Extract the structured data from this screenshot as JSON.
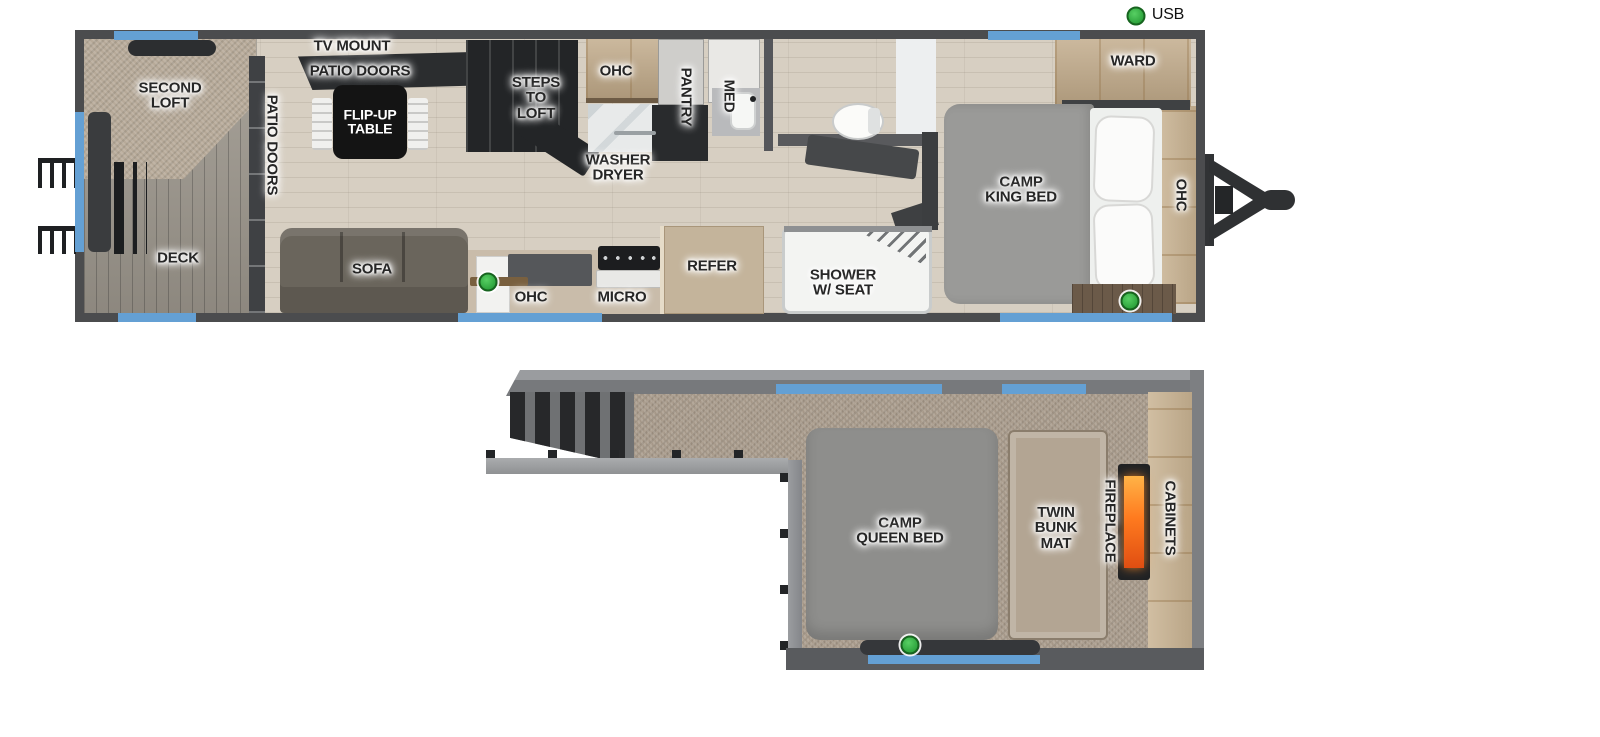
{
  "legend": {
    "usb": "USB",
    "usb_color": "#3db54a"
  },
  "colors": {
    "wall_dark": "#4b4c4e",
    "wall_light": "#85878a",
    "window_blue": "#64a0d4",
    "usb_green": "#3db54a",
    "fire_orange": "#ff7b1f",
    "table_black": "#141414"
  },
  "main_floor": {
    "second_loft": "SECOND\nLOFT",
    "deck": "DECK",
    "patio_doors_vert": "PATIO DOORS",
    "tv_mount": "TV MOUNT",
    "patio_doors": "PATIO DOORS",
    "flip_up_table": "FLIP-UP\nTABLE",
    "sofa": "SOFA",
    "steps_to_loft": "STEPS\nTO\nLOFT",
    "ohc_top": "OHC",
    "washer_dryer": "WASHER\nDRYER",
    "pantry": "PANTRY",
    "med": "MED",
    "ohc_kitchen": "OHC",
    "micro": "MICRO",
    "refer": "REFER",
    "shower_w_seat": "SHOWER\nW/ SEAT",
    "camp_king_bed": "CAMP\nKING BED",
    "ward": "WARD",
    "ohc_bed": "OHC"
  },
  "loft_floor": {
    "camp_queen_bed": "CAMP\nQUEEN BED",
    "twin_bunk_mat": "TWIN\nBUNK\nMAT",
    "fireplace": "FIREPLACE",
    "cabinets": "CABINETS"
  }
}
